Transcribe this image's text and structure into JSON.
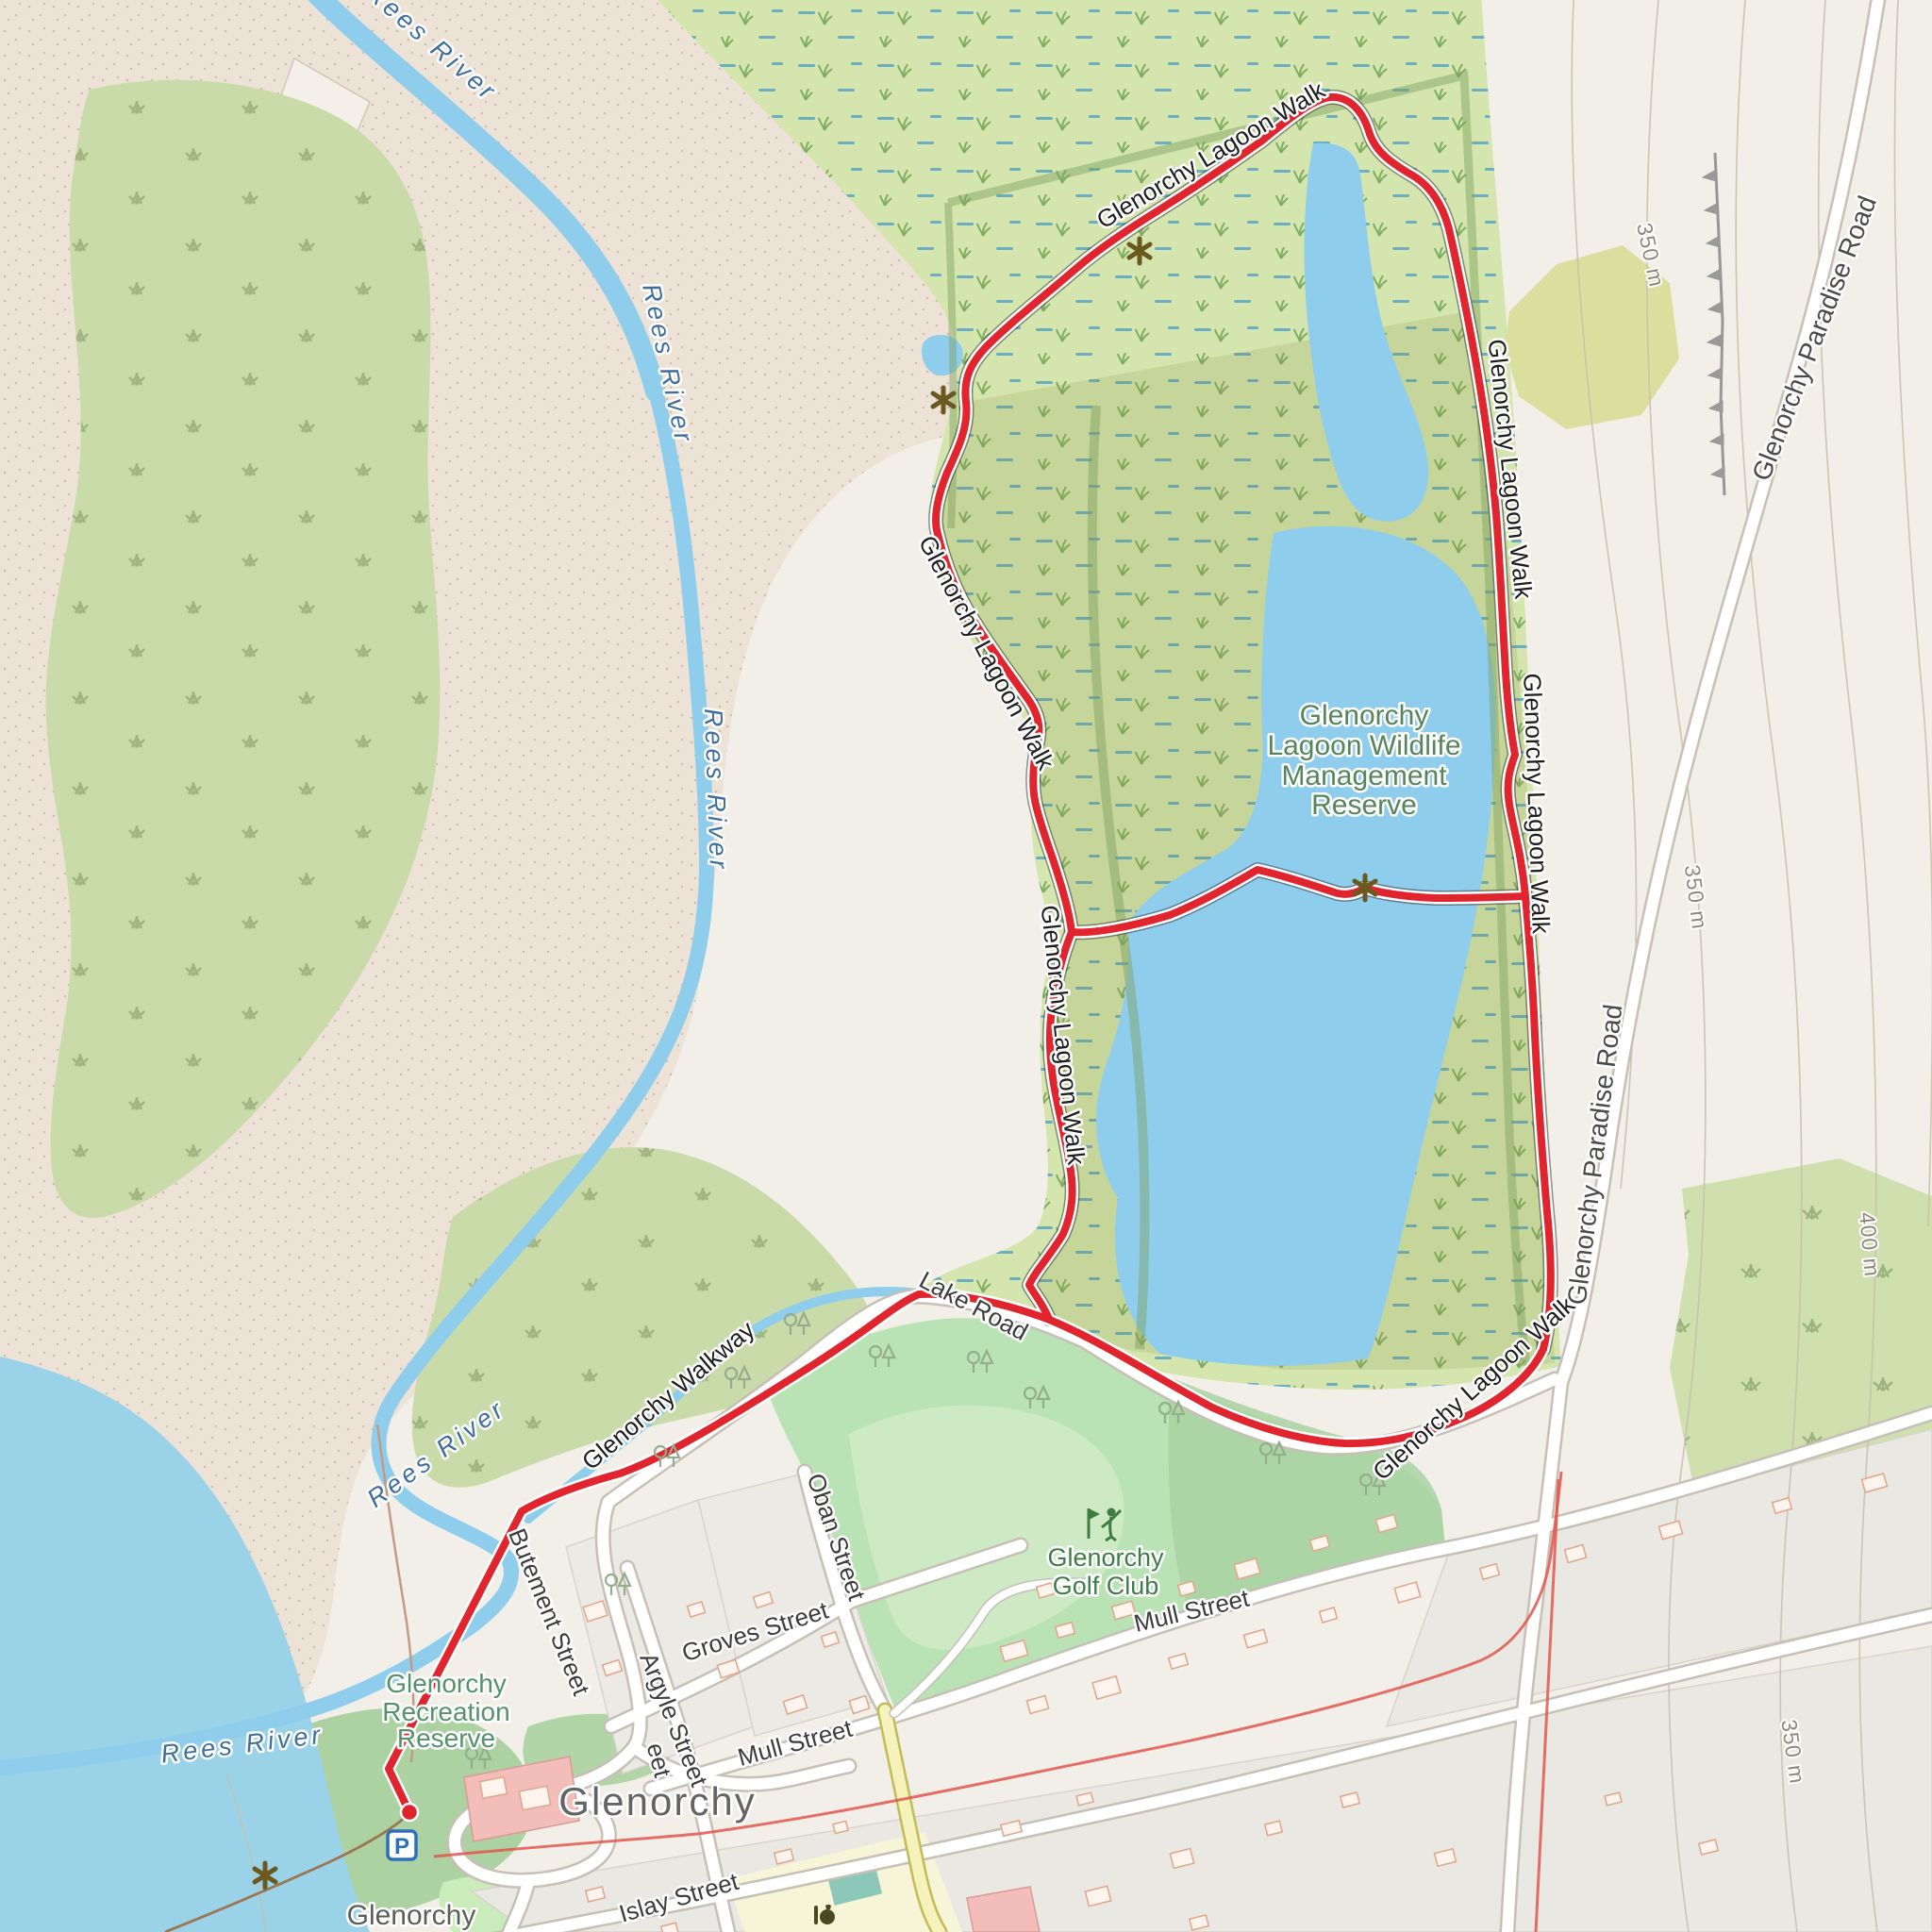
{
  "labels": {
    "river": "Rees River",
    "trail": "Glenorchy Lagoon Walk",
    "walkway": "Glenorchy Walkway",
    "paradise_road": "Glenorchy Paradise Road",
    "lake_road": "Lake Road",
    "reserve": [
      "Glenorchy",
      "Lagoon Wildlife",
      "Management",
      "Reserve"
    ],
    "golf": [
      "Glenorchy",
      "Golf Club"
    ],
    "recreation": [
      "Glenorchy",
      "Recreation",
      "Reserve"
    ],
    "town": "Glenorchy",
    "town_small": "Glenorchy",
    "streets": {
      "oban": "Oban Street",
      "groves": "Groves Street",
      "mull": "Mull Street",
      "islay": "Islay Street",
      "argyle": "Argyle Street",
      "butement": "Butement Street",
      "fragment": "eet"
    },
    "contours": {
      "c350": "350 m",
      "c400": "400 m"
    }
  },
  "icons": {
    "parking_letter": "P",
    "poi_marker": "wildlife-viewpoint-asterisk",
    "golf": "golfer-with-flag",
    "food": "food-poi",
    "route_end": "route-endpoint-dot"
  },
  "colors": {
    "route_red": "#e0252f",
    "water": "#8fcdec",
    "lake": "#9ad2e8",
    "wetland_green": "#d4e6ad",
    "scrub_green": "#cadbaa",
    "golf_green": "#b9e3b4",
    "sand": "#ece2d6",
    "land": "#f2efe8",
    "road_fill": "#ffffff",
    "road_casing": "#c6c0b6",
    "yellow_road": "#f5f2bb",
    "building": "#fdf4ed",
    "building_stroke": "#e0a98e",
    "pink_building": "#f3bdb9",
    "green_label": "#3e7d46",
    "reserve_label": "#56855c",
    "water_label": "#3f6d9c",
    "street_label": "#3c3c3c",
    "contour_label": "#8f887a",
    "town_label": "#646464",
    "poi_brown": "#6b5a20",
    "parking_blue": "#2a6fc0"
  }
}
